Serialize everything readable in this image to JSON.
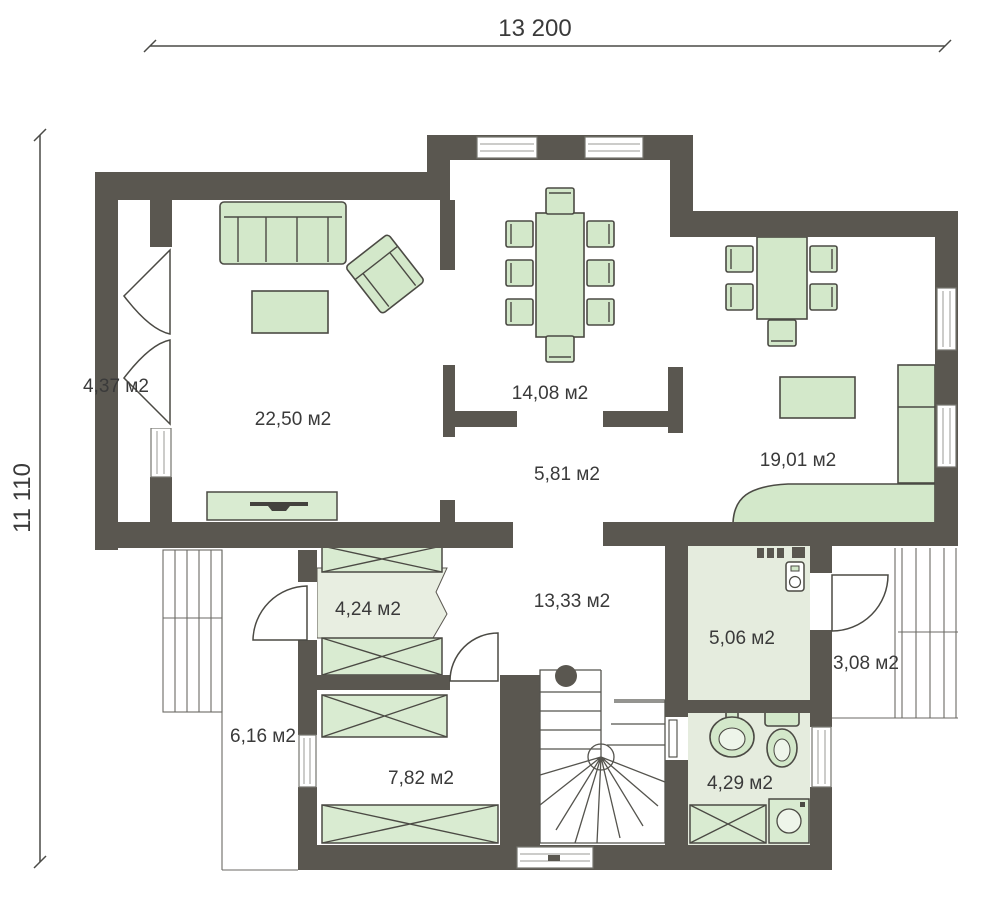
{
  "plan": {
    "type": "floor-plan",
    "dimensions": {
      "width_label": "13 200",
      "height_label": "11 110"
    },
    "colors": {
      "wall": "#5a5750",
      "furniture": "#d3e8ca",
      "furniture_stroke": "#4b4a44",
      "wardrobe": "#d9ebd1",
      "floor_light": "#e8eee1",
      "text": "#3a3a3a"
    },
    "rooms": [
      {
        "name": "porch",
        "area_label": "4,37 м2"
      },
      {
        "name": "living-room",
        "area_label": "22,50 м2"
      },
      {
        "name": "dining-room",
        "area_label": "14,08 м2"
      },
      {
        "name": "kitchen",
        "area_label": "19,01 м2"
      },
      {
        "name": "passage",
        "area_label": "5,81 м2"
      },
      {
        "name": "wardrobe",
        "area_label": "4,24 м2"
      },
      {
        "name": "hall",
        "area_label": "13,33 м2"
      },
      {
        "name": "boiler-room",
        "area_label": "5,06 м2"
      },
      {
        "name": "entry-porch",
        "area_label": "3,08 м2"
      },
      {
        "name": "terrace",
        "area_label": "6,16 м2"
      },
      {
        "name": "storage-room",
        "area_label": "7,82 м2"
      },
      {
        "name": "bathroom",
        "area_label": "4,29 м2"
      }
    ]
  }
}
